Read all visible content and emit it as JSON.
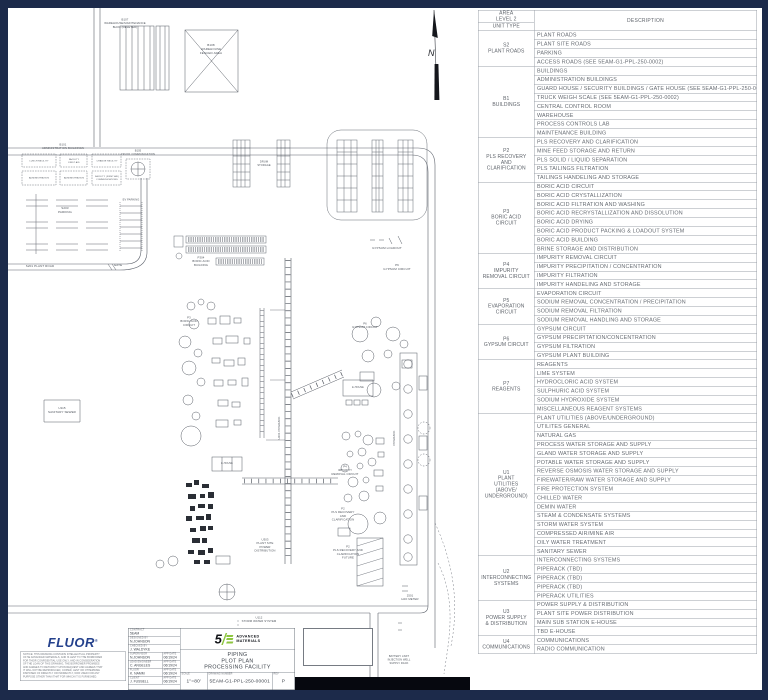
{
  "colors": {
    "frame_navy": "#1c2a4a",
    "line_gray": "#565b64",
    "fluor_blue": "#24418c",
    "logo_green": "#8dc63f",
    "redaction_black": "#06080f"
  },
  "plan": {
    "north_label": "N",
    "labels": [
      {
        "x": 117,
        "y": 16,
        "s": 2.8,
        "text": "B107\nWAREHOUSE/MAINTENANCE\nBLDG (DELETED)"
      },
      {
        "x": 203,
        "y": 42,
        "s": 3,
        "text": "B108\nWAREHOUSE\nFENCED AREA"
      },
      {
        "x": 55,
        "y": 139,
        "s": 2.8,
        "text": "B101\nADMINISTRATION BUILDINGS"
      },
      {
        "x": 130,
        "y": 145,
        "s": 2.6,
        "text": "B105\nTRUCK COMMUNICATION"
      },
      {
        "x": 31,
        "y": 152.5,
        "s": 2.2,
        "text": "LUNCH FACILITY"
      },
      {
        "x": 65.5,
        "y": 152.5,
        "s": 2.2,
        "text": "FACILITY\nFIRST AID"
      },
      {
        "x": 98.5,
        "y": 152.5,
        "s": 2.2,
        "text": "CHANGE FACILITY"
      },
      {
        "x": 31,
        "y": 170,
        "s": 2.2,
        "text": "ADMINISTRATION"
      },
      {
        "x": 65.5,
        "y": 170,
        "s": 2.2,
        "text": "ADMINISTRATION"
      },
      {
        "x": 98.5,
        "y": 170,
        "s": 2.2,
        "text": "FACILITY (FIRST AID)\nCOMMUNICATIONS"
      },
      {
        "x": 57,
        "y": 203,
        "s": 3,
        "text": "S203\nPARKING"
      },
      {
        "x": 123,
        "y": 192,
        "s": 2.6,
        "text": "EV PARKING"
      },
      {
        "x": 32,
        "y": 259,
        "s": 3,
        "text": "S201 PLANT ROAD"
      },
      {
        "x": 110,
        "y": 258,
        "s": 3,
        "text": "GATE"
      },
      {
        "x": 54,
        "y": 403,
        "s": 3,
        "text": "U115\nSANITARY SEWER"
      },
      {
        "x": 256,
        "y": 156,
        "s": 2.6,
        "text": "DRUM\nSTORAGE"
      },
      {
        "x": 193,
        "y": 254,
        "s": 2.8,
        "text": "P304\nBORIC ACID\nBUILDING"
      },
      {
        "x": 181,
        "y": 314,
        "s": 2.8,
        "text": "P3\nBORIC ACID\nCIRCUIT"
      },
      {
        "x": 379,
        "y": 241,
        "s": 3,
        "text": "GYPSUM LOADOUT"
      },
      {
        "x": 389,
        "y": 260,
        "s": 3,
        "text": "P6\nGYPSUM CIRCUIT"
      },
      {
        "x": 357,
        "y": 318,
        "s": 2.8,
        "text": "P6\nGYPSUM CIRCUIT"
      },
      {
        "x": 337,
        "y": 463,
        "s": 2.8,
        "text": "P4\nIMPURITY\nREMOVAL CIRCUIT"
      },
      {
        "x": 335,
        "y": 507,
        "s": 2.8,
        "text": "P2\nPLS RECOVERY\nAND\nCLARIFICATION"
      },
      {
        "x": 340,
        "y": 545,
        "s": 2.8,
        "text": "P2\nPLS RECOVERY AND\nCLARIFICATION\nFUTURE"
      },
      {
        "x": 257,
        "y": 538,
        "s": 2.8,
        "text": "U303\nPLANT SITE\nPOWER\nDISTRIBUTION"
      },
      {
        "x": 219,
        "y": 456,
        "s": 2.4,
        "text": "E-HOUSE"
      },
      {
        "x": 350,
        "y": 380,
        "s": 2.4,
        "text": "E-HOUSE"
      },
      {
        "x": 402,
        "y": 590,
        "s": 2.8,
        "text": "2501\nH2O METER"
      },
      {
        "x": 251,
        "y": 612,
        "s": 2.8,
        "text": "U112\nSTORM WATER SYSTEM"
      },
      {
        "x": 391,
        "y": 652,
        "s": 2.6,
        "text": "BATTERY LIMIT\nINJECTION WELL\nSUPPLY RACK"
      },
      {
        "x": 272,
        "y": 420,
        "s": 2.8,
        "rot": -90,
        "text": "U201 PIPERACK"
      },
      {
        "x": 387,
        "y": 430,
        "s": 2.8,
        "rot": -90,
        "text": "PIPERACK"
      }
    ]
  },
  "area_table": {
    "header": {
      "area_line1": "AREA",
      "area_line2": "LEVEL 2",
      "unit_type": "UNIT TYPE",
      "description": "DESCRIPTION"
    },
    "groups": [
      {
        "label_lines": [
          "S2",
          "PLANT ROADS"
        ],
        "rows": [
          "PLANT ROADS",
          "PLANT SITE ROADS",
          "PARKING",
          "ACCESS ROADS (SEE 5EAM-G1-PPL-250-0002)"
        ]
      },
      {
        "label_lines": [
          "B1",
          "BUILDINGS"
        ],
        "rows": [
          "BUILDINGS",
          "ADMINISTRATION BUILDINGS",
          "GUARD HOUSE / SECURITY BUILDINGS / GATE HOUSE (SEE 5EAM-G1-PPL-250-0002)",
          "TRUCK WEIGH SCALE (SEE 5EAM-G1-PPL-250-0002)",
          "CENTRAL CONTROL ROOM",
          "WAREHOUSE",
          "PROCESS CONTROLS LAB",
          "MAINTENANCE BUILDING"
        ]
      },
      {
        "label_lines": [
          "P2",
          "PLS RECOVERY",
          "AND",
          "CLARIFICATION"
        ],
        "rows": [
          "PLS RECOVERY AND CLARIFICATION",
          "MINE FEED STORAGE AND RETURN",
          "PLS SOLID / LIQUID SEPARATION",
          "PLS TAILINGS FILTRATION",
          "TAILINGS HANDELING AND STORAGE"
        ]
      },
      {
        "label_lines": [
          "P3",
          "BORIC ACID",
          "CIRCUIT"
        ],
        "rows": [
          "BORIC ACID CIRCUIT",
          "BORIC ACID CRYSTALLIZATION",
          "BORIC ACID FILTRATION AND WASHING",
          "BORIC ACID RECRYSTALLIZATION AND DISSOLUTION",
          "BORIC ACID DRYING",
          "BORIC ACID PRODUCT PACKING & LOADOUT SYSTEM",
          "BORIC ACID BUILDING",
          "BRINE STORAGE AND DISTRIBUTION"
        ]
      },
      {
        "label_lines": [
          "P4",
          "IMPURITY",
          "REMOVAL CIRCUIT"
        ],
        "rows": [
          "IMPURITY REMOVAL CIRCUIT",
          "IMPURITY PRECIPITATION / CONCENTRATION",
          "IMPURITY FILTRATION",
          "IMPURITY HANDELING AND STORAGE"
        ]
      },
      {
        "label_lines": [
          "P5",
          "EVAPORATION",
          "CIRCUIT"
        ],
        "rows": [
          "EVAPORATION CIRCUIT",
          "SODIUM REMOVAL CONCENTRATION / PRECIPITATION",
          "SODIUM REMOVAL FILTRATION",
          "SODIUM REMOVAL HANDLING AND STORAGE"
        ]
      },
      {
        "label_lines": [
          "P6",
          "GYPSUM CIRCUIT"
        ],
        "rows": [
          "GYPSUM CIRCUIT",
          "GYPSUM PRECIPITATION/CONCENTRATION",
          "GYPSUM FILTRATION",
          "GYPSUM PLANT BUILDING"
        ]
      },
      {
        "label_lines": [
          "P7",
          "REAGENTS"
        ],
        "rows": [
          "REAGENTS",
          "LIME SYSTEM",
          "HYDROCLORIC ACID SYSTEM",
          "SULPHURIC ACID SYSTEM",
          "SODIUM HYDROXIDE SYSTEM",
          "MISCELLANEOUS REAGENT SYSTEMS"
        ]
      },
      {
        "label_lines": [
          "U1",
          "PLANT",
          "UTILITIES",
          "(ABOVE/",
          "UNDERGROUND)"
        ],
        "rows": [
          "PLANT UTILITIES (ABOVE/UNDERGROUND)",
          "UTILITES GENERAL",
          "NATURAL GAS",
          "PROCESS WATER STORAGE AND SUPPLY",
          "GLAND WATER STORAGE AND SUPPLY",
          "POTABLE WATER STORAGE AND SUPPLY",
          "REVERSE OSMOSIS WATER STORAGE AND SUPPLY",
          "FIREWATER/RAW WATER STORAGE AND SUPPLY",
          "FIRE PROTECTION SYSTEM",
          "CHILLED WATER",
          "DEMIN WATER",
          "STEAM & CONDENSATE SYSTEMS",
          "STORM WATER SYSTEM",
          "COMPRESSED AIR/MINE AIR",
          "OILY WATER TREATMENT",
          "SANITARY SEWER"
        ]
      },
      {
        "label_lines": [
          "U2",
          "INTERCONNECTING",
          "SYSTEMS"
        ],
        "rows": [
          "INTERCONNECTING SYSTEMS",
          "PIPERACK (TBD)",
          "PIPERACK (TBD)",
          "PIPERACK (TBD)",
          "PIPERACK UTILITIES"
        ]
      },
      {
        "label_lines": [
          "U3",
          "POWER SUPPLY",
          "& DISTRIBUTION"
        ],
        "rows": [
          "POWER SUPPLY & DISTRIBUTION",
          "PLANT SITE POWER DISTRIBUTION",
          "MAIN SUB STATION E-HOUSE",
          "TBD E-HOUSE"
        ]
      },
      {
        "label_lines": [
          "U4",
          "COMMUNICATIONS"
        ],
        "rows": [
          "COMMUNICATIONS",
          "RADIO COMMUNICATION"
        ]
      }
    ]
  },
  "title_block": {
    "fluor_logo": "FLUOR",
    "fluor_reg": "®",
    "notice": "NOTICE: THIS DRAWING CONTAINS INTELLECTUAL PROPERTY\nOF 5E ADVANCED MATERIALS, AND IS LENT TO THE BORROWER\nFOR THEIR CONFIDENTIAL USE ONLY, AND IN CONSIDERATION\nOF THE LOAN OF THIS DRAWING, THE BORROWER PROMISES\nAND AGREES TO RETURN IT UPON REQUEST AND AGREES THAT\nIT WILL NOT BE REPRODUCED, COPIED, LENT OR OTHERWISE\nDISPOSED OF DIRECTLY OR INDIRECTLY, NOR USED FOR ANY\nPURPOSE OTHER THAN THAT FOR WHICH IT IS FURNISHED.",
    "personnel": [
      {
        "role": "CONTRACT",
        "name": "5EAM"
      },
      {
        "role": "DESIGNED BY",
        "name": "N.JOHNSON"
      },
      {
        "role": "CHECKED BY",
        "name": "J. WALDYKE"
      },
      {
        "role": "SUPERVISOR",
        "name": "N.JOHNSON",
        "app": "APP DATE",
        "date": "06/19/24"
      },
      {
        "role": "LEAD ENGINEER",
        "name": "C. ANGELES",
        "app": "APP DATE",
        "date": "06/19/24"
      },
      {
        "role": "FLUOR",
        "name": "K. NAMM",
        "app": "APP DATE",
        "date": "06/19/24"
      },
      {
        "role": "CLIENT",
        "name": "J. FUSSELL",
        "app": "APP DATE",
        "date": "06/19/24"
      }
    ],
    "logo_5e": {
      "five": "5",
      "brand_line1": "ADVANCED",
      "brand_line2": "MATERIALS"
    },
    "title_lines": [
      "PIPING",
      "PLOT PLAN",
      "PROCESSING FACILITY"
    ],
    "scale_label": "SCALE",
    "scale_value": "1\"=80'",
    "number_label": "DRAWING NUMBER",
    "number_value": "5EAM-G1-PPL-250-00001",
    "rev_label": "REV",
    "rev_value": "P"
  }
}
